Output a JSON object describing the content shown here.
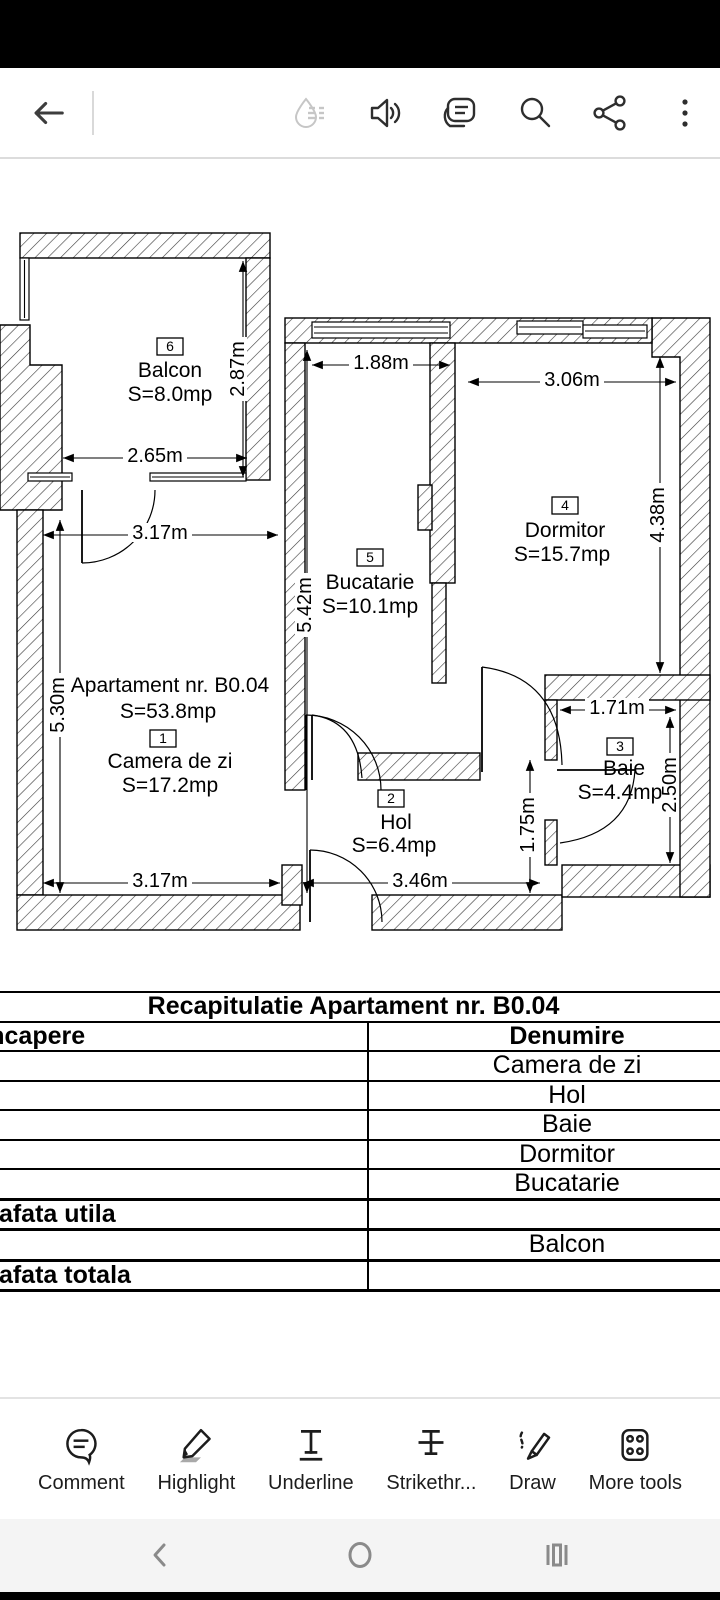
{
  "topbar": {
    "icons": [
      "back",
      "liquid-mode",
      "read-aloud",
      "comment",
      "search",
      "share",
      "overflow-menu"
    ]
  },
  "plan": {
    "apartment_title": "Apartament nr. B0.04",
    "apartment_area": "S=53.8mp",
    "rooms": [
      {
        "no": "1",
        "name": "Camera de zi",
        "area": "S=17.2mp"
      },
      {
        "no": "2",
        "name": "Hol",
        "area": "S=6.4mp"
      },
      {
        "no": "3",
        "name": "Baie",
        "area": "S=4.4mp"
      },
      {
        "no": "4",
        "name": "Dormitor",
        "area": "S=15.7mp"
      },
      {
        "no": "5",
        "name": "Bucatarie",
        "area": "S=10.1mp"
      },
      {
        "no": "6",
        "name": "Balcon",
        "area": "S=8.0mp"
      }
    ],
    "dims": {
      "balcon_w": "2.65m",
      "balcon_h": "2.87m",
      "lr_top_w": "3.17m",
      "lr_h": "5.30m",
      "lr_bottom_w": "3.17m",
      "kitchen_w": "1.88m",
      "kitchen_h": "5.42m",
      "dorm_w": "3.06m",
      "dorm_h": "4.38m",
      "hol_w": "3.46m",
      "hol_h": "1.75m",
      "baie_w": "1.71m",
      "baie_h": "2.50m"
    }
  },
  "table": {
    "title": "Recapitulatie Apartament nr. B0.04",
    "headers": [
      "Nr. Incapere",
      "Denumire"
    ],
    "rows": [
      {
        "c1": "1",
        "c2": "Camera de zi"
      },
      {
        "c1": "2",
        "c2": "Hol"
      },
      {
        "c1": "3",
        "c2": "Baie"
      },
      {
        "c1": "4",
        "c2": "Dormitor"
      },
      {
        "c1": "5",
        "c2": "Bucatarie"
      },
      {
        "c1": "Suprafata utila",
        "c2": ""
      },
      {
        "c1": "6",
        "c2": "Balcon"
      },
      {
        "c1": "Suprafata totala",
        "c2": ""
      }
    ]
  },
  "bottom_toolbar": {
    "items": [
      {
        "label": "Comment"
      },
      {
        "label": "Highlight"
      },
      {
        "label": "Underline"
      },
      {
        "label": "Strikethr..."
      },
      {
        "label": "Draw"
      },
      {
        "label": "More tools"
      }
    ]
  },
  "navbar": {
    "icons": [
      "back",
      "home",
      "recents"
    ]
  }
}
